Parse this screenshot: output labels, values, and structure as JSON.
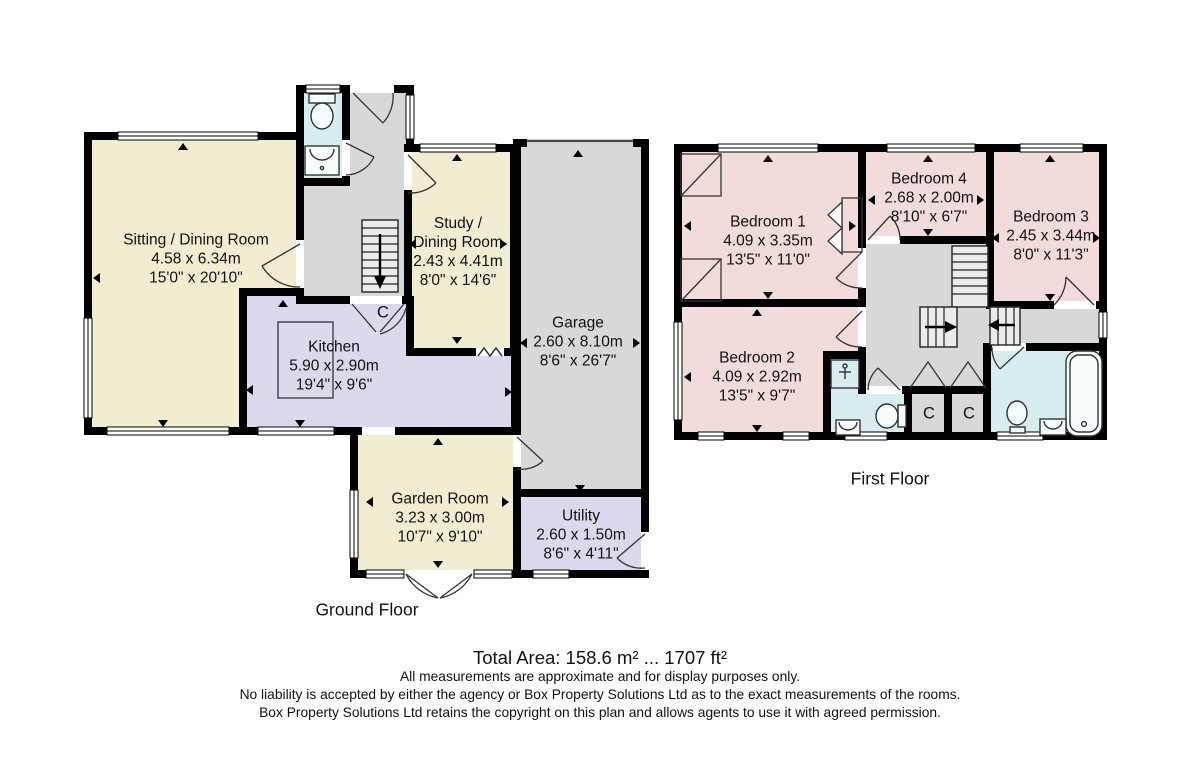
{
  "palette": {
    "wall": "#000000",
    "cream": "#f0edd1",
    "lavender": "#dbdaec",
    "gray": "#d8d8d8",
    "pink": "#f2dcdb",
    "blue": "#d7edef",
    "stair": "#ebebeb"
  },
  "ground_floor": {
    "label": "Ground Floor",
    "cupboard": "C",
    "rooms": {
      "sitting": {
        "name": "Sitting / Dining Room",
        "metric": "4.58 x 6.34m",
        "imperial": "15'0\" x 20'10\""
      },
      "study": {
        "name": "Study /",
        "name2": "Dining Room",
        "metric": "2.43 x 4.41m",
        "imperial": "8'0\" x 14'6\""
      },
      "kitchen": {
        "name": "Kitchen",
        "metric": "5.90 x 2.90m",
        "imperial": "19'4\" x 9'6\""
      },
      "garage": {
        "name": "Garage",
        "metric": "2.60 x 8.10m",
        "imperial": "8'6\" x 26'7\""
      },
      "garden": {
        "name": "Garden Room",
        "metric": "3.23 x 3.00m",
        "imperial": "10'7\" x 9'10\""
      },
      "utility": {
        "name": "Utility",
        "metric": "2.60 x 1.50m",
        "imperial": "8'6\" x 4'11\""
      }
    }
  },
  "first_floor": {
    "label": "First Floor",
    "cupboard1": "C",
    "cupboard2": "C",
    "rooms": {
      "bed1": {
        "name": "Bedroom 1",
        "metric": "4.09 x 3.35m",
        "imperial": "13'5\" x 11'0\""
      },
      "bed2": {
        "name": "Bedroom 2",
        "metric": "4.09 x 2.92m",
        "imperial": "13'5\" x 9'7\""
      },
      "bed3": {
        "name": "Bedroom 3",
        "metric": "2.45 x 3.44m",
        "imperial": "8'0\" x 11'3\""
      },
      "bed4": {
        "name": "Bedroom 4",
        "metric": "2.68 x 2.00m",
        "imperial": "8'10\" x 6'7\""
      }
    }
  },
  "footer": {
    "total_area": "Total Area: 158.6 m² ... 1707 ft²",
    "disclaimer1": "All measurements are approximate and for display purposes only.",
    "disclaimer2": "No liability is accepted by either the agency or Box Property Solutions Ltd as to the exact measurements of the rooms.",
    "disclaimer3": "Box Property Solutions Ltd retains the copyright on this plan and allows agents to use it with agreed permission."
  }
}
